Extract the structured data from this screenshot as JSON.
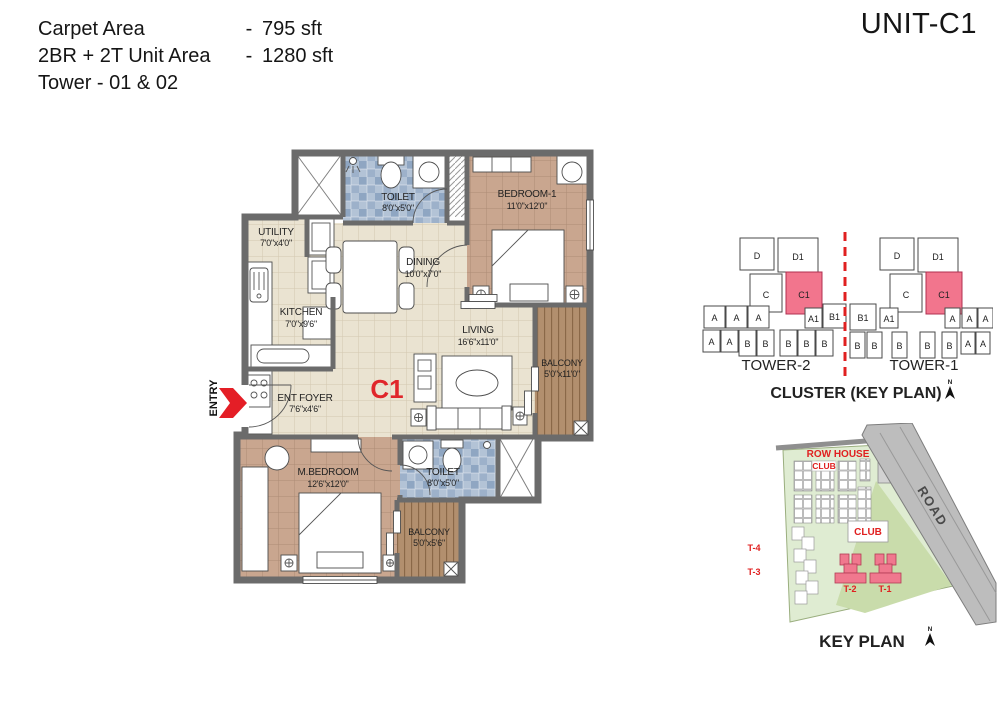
{
  "header": {
    "unit_title": "UNIT-C1",
    "rows": [
      {
        "label": "Carpet Area",
        "dash": "-",
        "value": "795 sft"
      },
      {
        "label": "2BR + 2T Unit Area",
        "dash": "-",
        "value": "1280 sft"
      }
    ],
    "tower_line": "Tower - 01 & 02"
  },
  "floor_plan": {
    "unit_label": "C1",
    "entry_label": "ENTRY",
    "rooms": {
      "toilet1": {
        "name": "TOILET",
        "dims": "8'0\"x5'0\""
      },
      "bedroom1": {
        "name": "BEDROOM-1",
        "dims": "11'0\"x12'0\""
      },
      "utility": {
        "name": "UTILITY",
        "dims": "7'0\"x4'0\""
      },
      "dining": {
        "name": "DINING",
        "dims": "10'0\"x7'0\""
      },
      "kitchen": {
        "name": "KITCHEN",
        "dims": "7'0\"x9'6\""
      },
      "living": {
        "name": "LIVING",
        "dims": "16'6\"x11'0\""
      },
      "balcony_right": {
        "name": "BALCONY",
        "dims": "5'0\"x11'0\""
      },
      "ent_foyer": {
        "name": "ENT FOYER",
        "dims": "7'6\"x4'6\""
      },
      "m_bedroom": {
        "name": "M.BEDROOM",
        "dims": "12'6\"x12'0\""
      },
      "toilet2": {
        "name": "TOILET",
        "dims": "8'0\"x5'0\""
      },
      "balcony_bottom": {
        "name": "BALCONY",
        "dims": "5'0\"x5'6\""
      }
    }
  },
  "cluster_plan": {
    "title": "CLUSTER (KEY PLAN)",
    "north_label": "N",
    "tower2": {
      "label": "TOWER-2",
      "units": [
        "D",
        "D1",
        "C",
        "C1",
        "A",
        "A",
        "A",
        "A1",
        "B1",
        "A",
        "A",
        "B",
        "B",
        "B",
        "B",
        "B"
      ]
    },
    "tower1": {
      "label": "TOWER-1",
      "units": [
        "D",
        "D1",
        "C",
        "C1",
        "B1",
        "A1",
        "A",
        "A",
        "A",
        "B",
        "B",
        "B",
        "B",
        "B",
        "A",
        "A"
      ]
    }
  },
  "key_plan": {
    "title": "KEY PLAN",
    "north_label": "N",
    "row_house_label": "ROW HOUSE",
    "club_top_label": "CLUB",
    "club_center_label": "CLUB",
    "road_label": "ROAD",
    "towers": [
      "T-4",
      "T-3",
      "T-2",
      "T-1"
    ]
  },
  "colors": {
    "accent_red": "#e02020",
    "highlight_pink": "#f2758d",
    "wall_gray": "#6b6b6b",
    "floor_cream": "#eae3d1",
    "floor_tan": "#c9a68f",
    "toilet_blue": "#a9bed6",
    "balcony_wood": "#b28f6e",
    "site_green": "#dfecd2"
  }
}
